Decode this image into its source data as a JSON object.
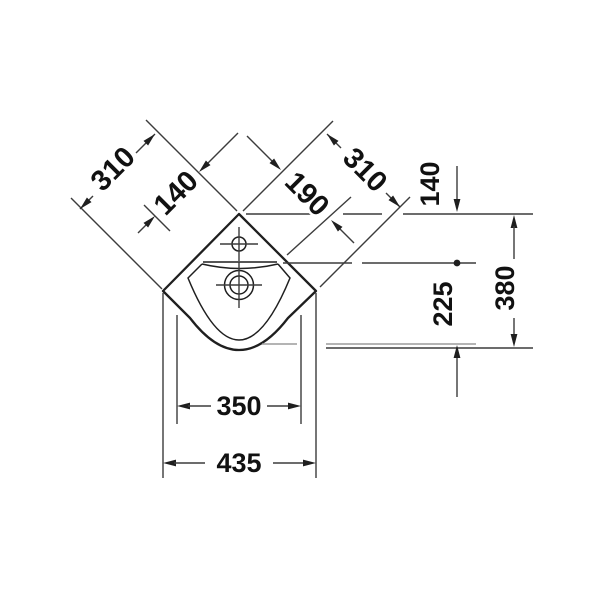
{
  "drawing": {
    "kind": "corner washbasin technical plan drawing",
    "dimensions": {
      "back_left_width": "310",
      "back_left_offset": "140",
      "back_right_offset": "190",
      "back_right_width": "310",
      "side_top_offset": "140",
      "side_total_depth": "380",
      "side_front_depth": "225",
      "bottom_inner_width": "350",
      "bottom_overall_width": "435"
    },
    "style": {
      "background": "#ffffff",
      "object_line_color": "#1f1f1f",
      "dimension_line_color": "#3c3c3c",
      "light_line_color": "#9b9b9b",
      "text_color": "#111111"
    }
  }
}
